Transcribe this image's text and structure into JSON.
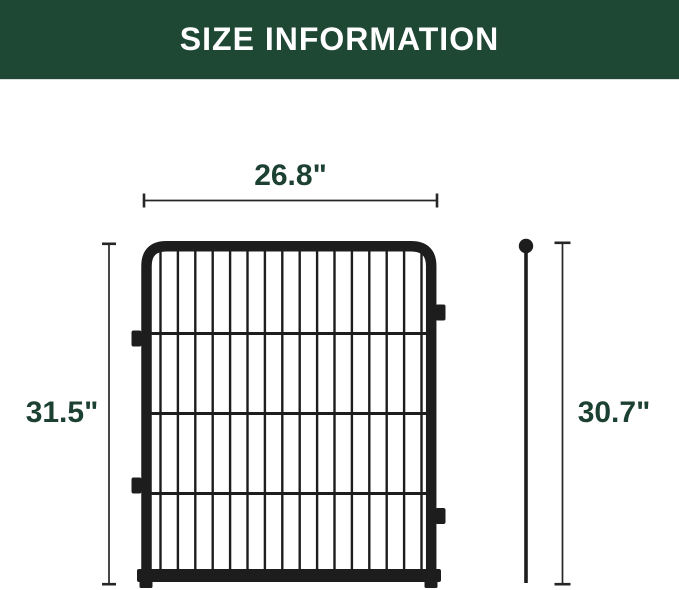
{
  "header": {
    "title": "SIZE INFORMATION",
    "bg_color": "#1E4734",
    "text_color": "#FFFFFF"
  },
  "diagram": {
    "panel": {
      "width_label": "26.8\"",
      "height_label": "31.5\"",
      "vertical_bar_count": 16,
      "horizontal_bar_count": 3,
      "metal_color": "#1D1D1D"
    },
    "stake": {
      "height_label": "30.7\""
    },
    "dimension_line_color": "#262626",
    "label_color": "#1C4132"
  }
}
